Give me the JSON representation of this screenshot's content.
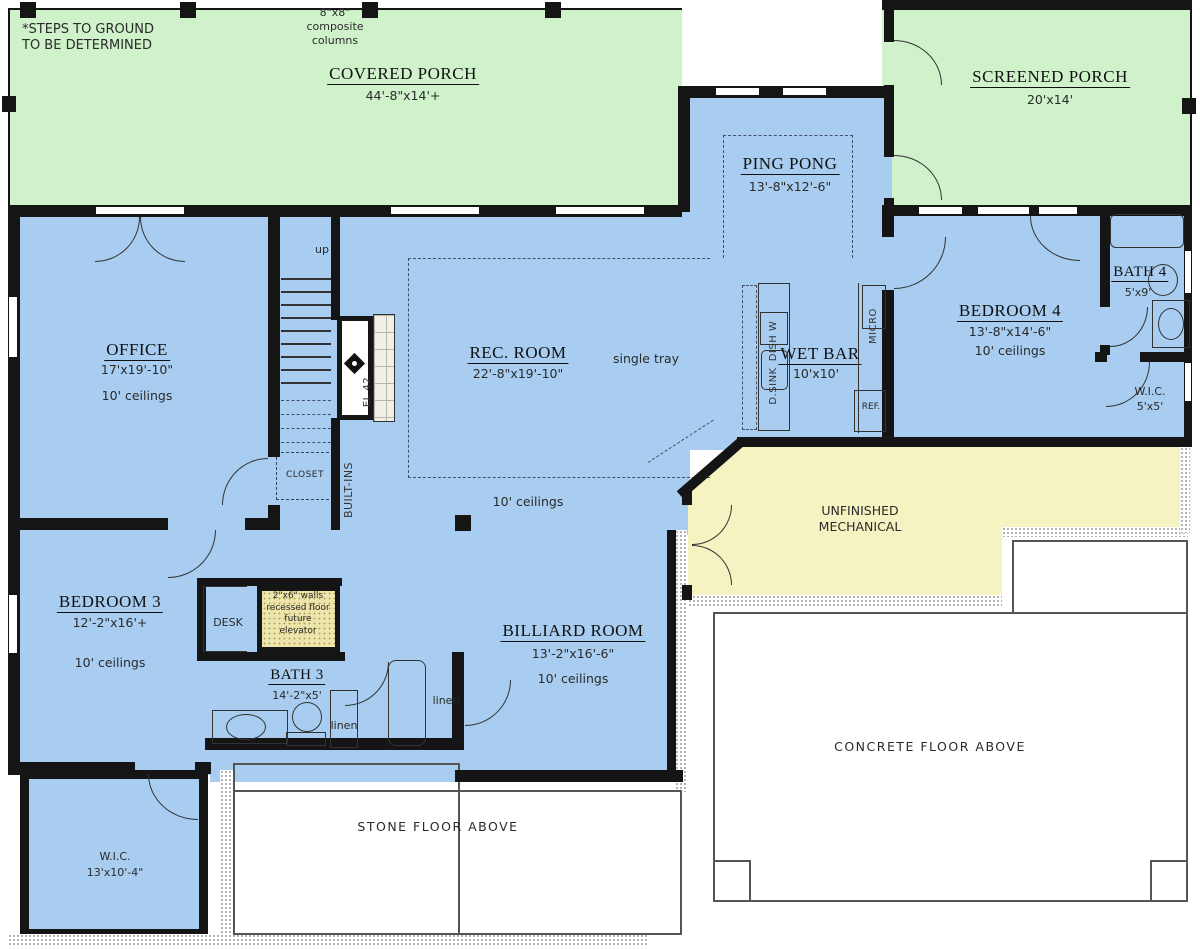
{
  "colors": {
    "porch_green": "#cff2cb",
    "room_blue": "#a8cdf0",
    "mech_yellow": "#f6f3c3",
    "elev_yellow": "#ede5ac",
    "elev_dot": "#b3a660",
    "wall": "#151515"
  },
  "rooms": {
    "covered_porch": {
      "name": "COVERED PORCH",
      "dims": "44'-8\"x14'+"
    },
    "screened_porch": {
      "name": "SCREENED PORCH",
      "dims": "20'x14'"
    },
    "ping_pong": {
      "name": "PING PONG",
      "dims": "13'-8\"x12'-6\""
    },
    "office": {
      "name": "OFFICE",
      "dims": "17'x19'-10\"",
      "ceiling": "10' ceilings"
    },
    "rec_room": {
      "name": "REC. ROOM",
      "dims": "22'-8\"x19'-10\""
    },
    "wet_bar": {
      "name": "WET BAR",
      "dims": "10'x10'"
    },
    "bedroom4": {
      "name": "BEDROOM 4",
      "dims": "13'-8\"x14'-6\"",
      "ceiling": "10' ceilings"
    },
    "bath4": {
      "name": "BATH 4",
      "dims": "5'x9'"
    },
    "wic4": {
      "name": "W.I.C.",
      "dims": "5'x5'"
    },
    "mechanical": {
      "name": "UNFINISHED\nMECHANICAL"
    },
    "bedroom3": {
      "name": "BEDROOM 3",
      "dims": "12'-2\"x16'+",
      "ceiling": "10' ceilings"
    },
    "bath3": {
      "name": "BATH 3",
      "dims": "14'-2\"x5'"
    },
    "billiard": {
      "name": "BILLIARD ROOM",
      "dims": "13'-2\"x16'-6\"",
      "ceiling": "10' ceilings"
    },
    "wic3": {
      "name": "W.I.C.",
      "dims": "13'x10'-4\""
    }
  },
  "notes": {
    "steps": "*STEPS TO GROUND\nTO BE DETERMINED",
    "columns": "8\"x8\"\ncomposite\ncolumns",
    "single_tray": "single tray",
    "rec_ceiling": "10' ceilings",
    "up": "up",
    "closet": "CLOSET",
    "built_ins": "BUILT-INS",
    "desk": "DESK",
    "elevator": "2\"x6\" walls\nrecessed floor\nfuture\nelevator",
    "linen_a": "linen",
    "linen_b": "linen",
    "fireplace": "EL 42",
    "stone_floor": "STONE FLOOR ABOVE",
    "concrete_floor": "CONCRETE FLOOR ABOVE"
  },
  "appliances": {
    "dishwasher": "DISH W",
    "bar_sink": "D.SINK",
    "microwave": "MICRO",
    "fridge": "REF."
  }
}
